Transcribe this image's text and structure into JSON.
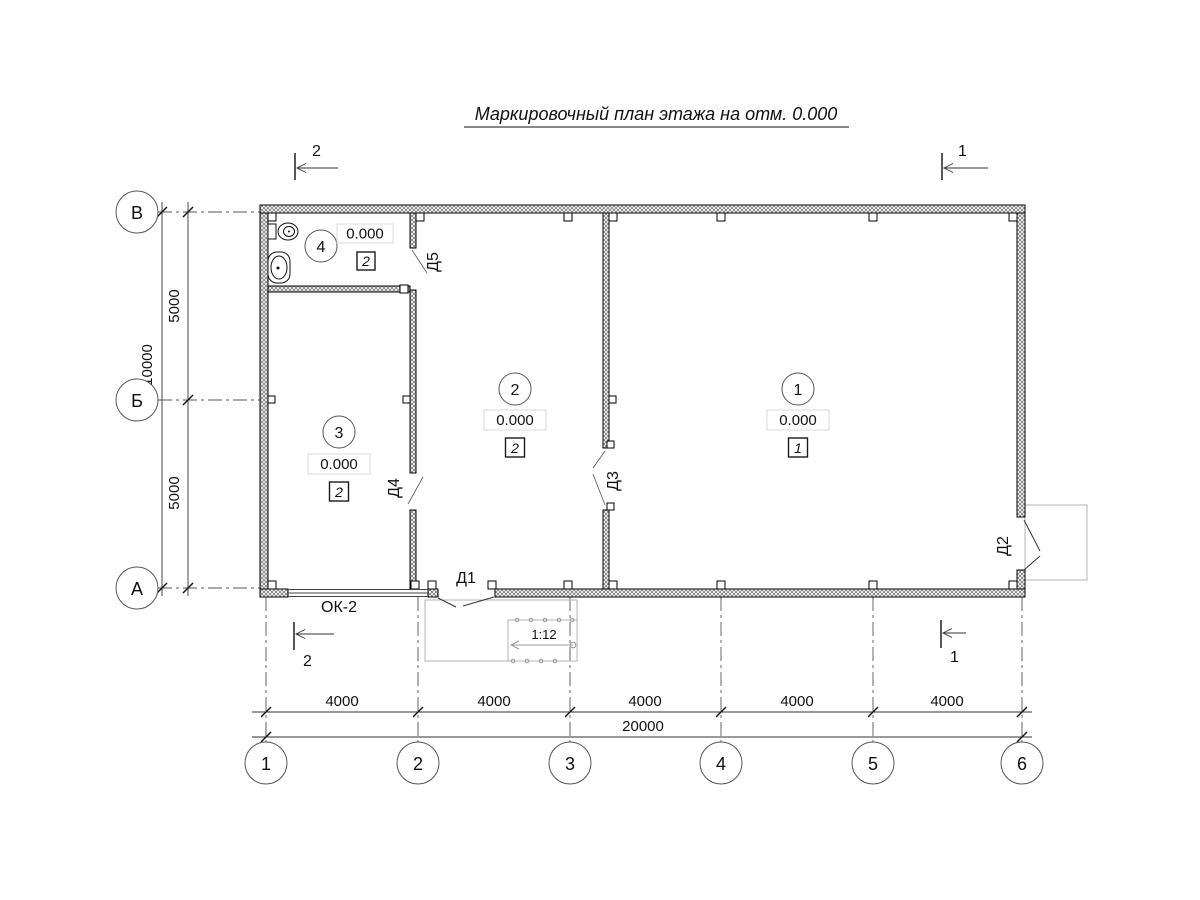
{
  "title": "Маркировочный план этажа на отм. 0.000",
  "axes": {
    "rows": [
      {
        "label": "В"
      },
      {
        "label": "Б"
      },
      {
        "label": "А"
      }
    ],
    "cols": [
      {
        "label": "1"
      },
      {
        "label": "2"
      },
      {
        "label": "3"
      },
      {
        "label": "4"
      },
      {
        "label": "5"
      },
      {
        "label": "6"
      }
    ]
  },
  "dims": {
    "row_total": "10000",
    "row_segments": [
      "5000",
      "5000"
    ],
    "col_segments": [
      "4000",
      "4000",
      "4000",
      "4000",
      "4000"
    ],
    "col_total": "20000"
  },
  "rooms": [
    {
      "number": "1",
      "elevation": "0.000",
      "floor_type": "1"
    },
    {
      "number": "2",
      "elevation": "0.000",
      "floor_type": "2"
    },
    {
      "number": "3",
      "elevation": "0.000",
      "floor_type": "2"
    },
    {
      "number": "4",
      "elevation": "0.000",
      "floor_type": "2"
    }
  ],
  "doors": [
    {
      "label": "Д1"
    },
    {
      "label": "Д2"
    },
    {
      "label": "Д3"
    },
    {
      "label": "Д4"
    },
    {
      "label": "Д5"
    }
  ],
  "window": {
    "label": "ОК-2"
  },
  "ramp": {
    "slope": "1:12"
  },
  "sections": [
    {
      "label": "1"
    },
    {
      "label": "2"
    }
  ],
  "colors": {
    "line": "#1a1a1a",
    "axis": "#555555",
    "light": "#b3b3b3"
  }
}
